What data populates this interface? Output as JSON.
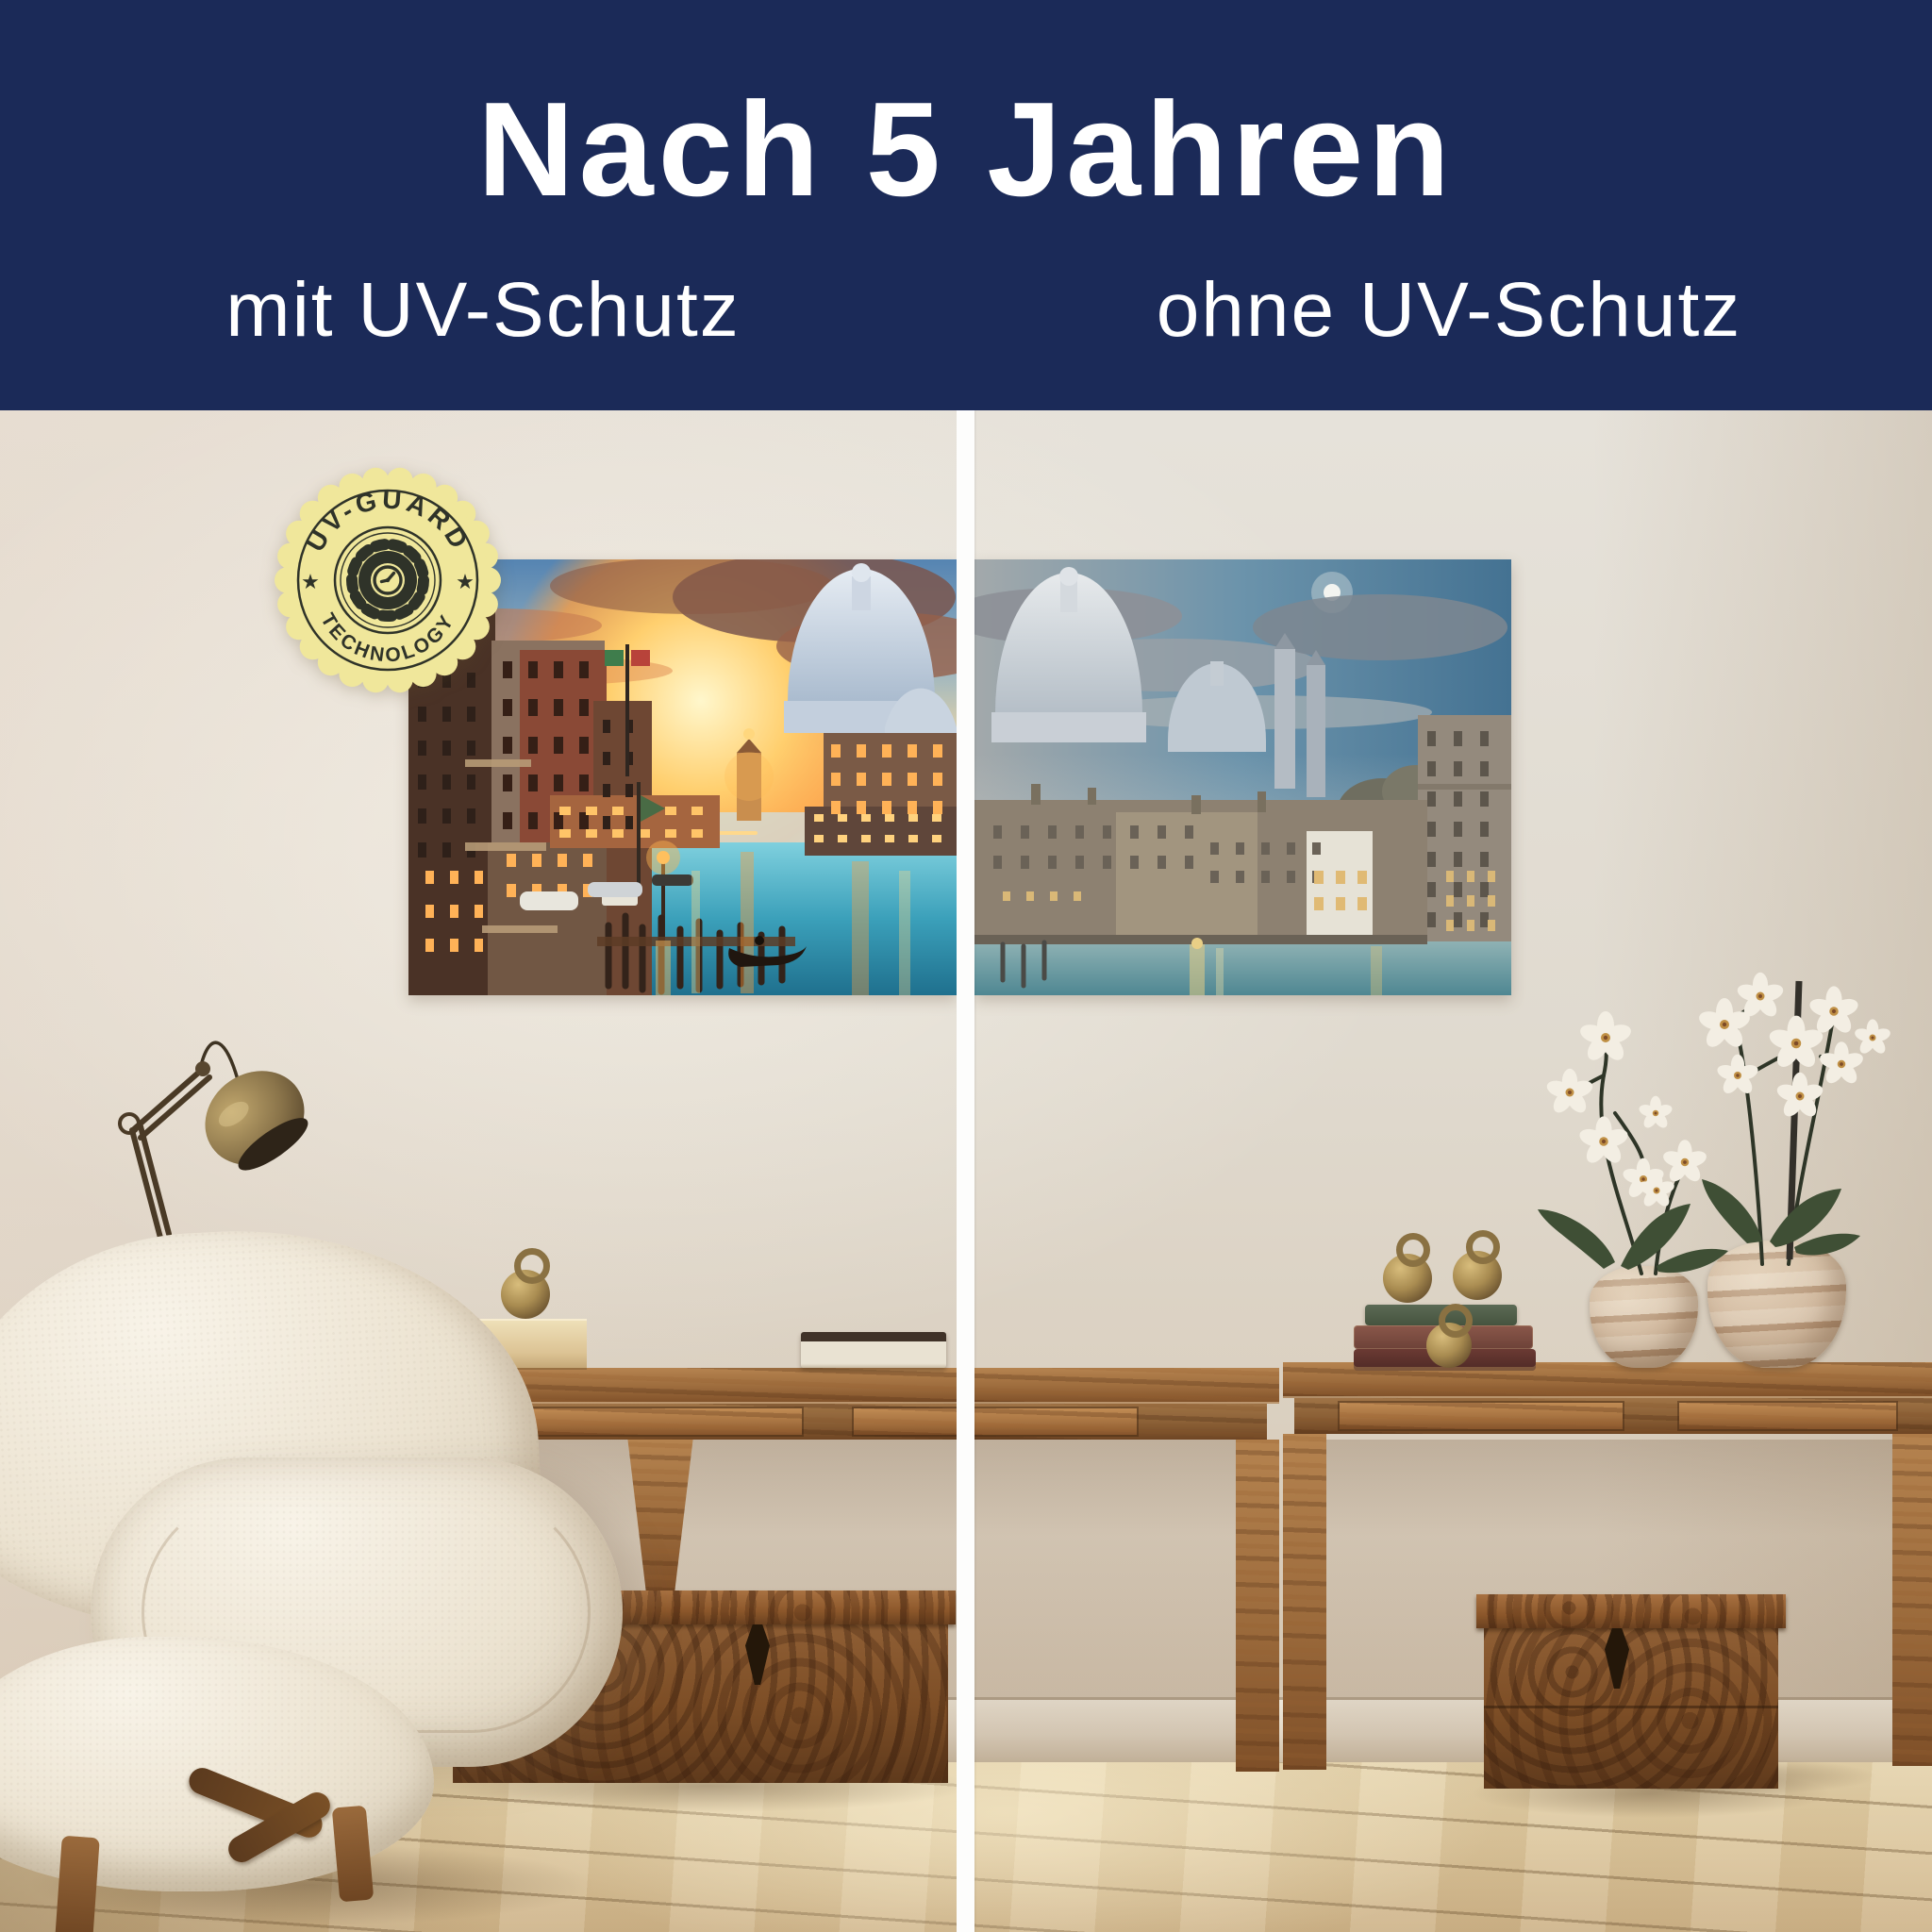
{
  "header": {
    "title": "Nach 5 Jahren",
    "subtitle_left": "mit UV-Schutz",
    "subtitle_right": "ohne UV-Schutz",
    "background_color": "#1b2a58",
    "text_color": "#ffffff"
  },
  "badge": {
    "arc_top": "UV-GUARD",
    "arc_bottom": "TECHNOLOGY",
    "star_left": "★",
    "star_right": "★",
    "fill_color": "#f0e79b",
    "ink_color": "#2f3329",
    "icon": "gear-clock-icon"
  },
  "scene": {
    "divider_color": "#ffffff",
    "artwork_left": "venice-canal-sunset-vibrant",
    "artwork_right": "venice-canal-sunset-faded"
  }
}
